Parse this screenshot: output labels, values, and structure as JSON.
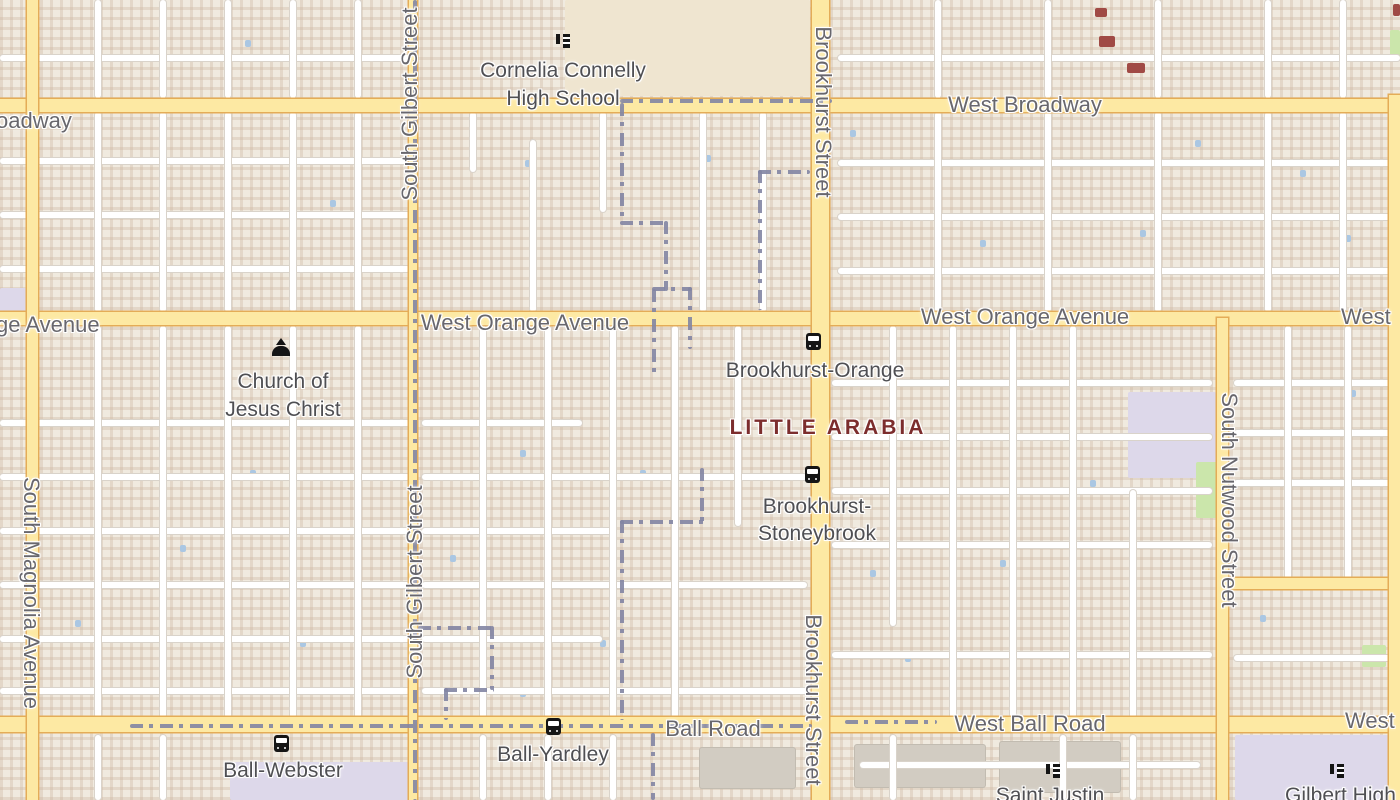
{
  "map_labels": {
    "streets": {
      "west_broadway": "West Broadway",
      "broadway_fragment": "oadway",
      "west_orange_avenue": "West Orange Avenue",
      "orange_fragment": "ge Avenue",
      "west_fragment": "West",
      "ball_road": "Ball Road",
      "west_ball_road": "West Ball Road",
      "south_gilbert_street": "South Gilbert Street",
      "brookhurst_street": "Brookhurst Street",
      "south_magnolia_avenue": "South Magnolia Avenue",
      "south_nutwood_street": "South Nutwood Street"
    },
    "neighborhood": {
      "little_arabia": "LITTLE ARABIA"
    },
    "pois": {
      "cornelia_line1": "Cornelia Connelly",
      "cornelia_line2": "High School",
      "church_line1": "Church of",
      "church_line2": "Jesus Christ",
      "saint_justin": "Saint Justin",
      "gilbert_high": "Gilbert High"
    },
    "bus_stops": {
      "brookhurst_orange": "Brookhurst-Orange",
      "brookhurst_stoneybrook_line1": "Brookhurst-",
      "brookhurst_stoneybrook_line2": "Stoneybrook",
      "ball_webster": "Ball-Webster",
      "ball_yardley": "Ball-Yardley"
    },
    "colors": {
      "road_major_fill": "#fde9a3",
      "road_major_casing": "#e4ac57",
      "boundary": "#8285a3",
      "neighborhood_text": "#7c2d2d",
      "road_label_text": "#68676d",
      "poi_label_text": "#4f4f53",
      "background": "#f0eadf",
      "water": "#aac7e3"
    }
  }
}
